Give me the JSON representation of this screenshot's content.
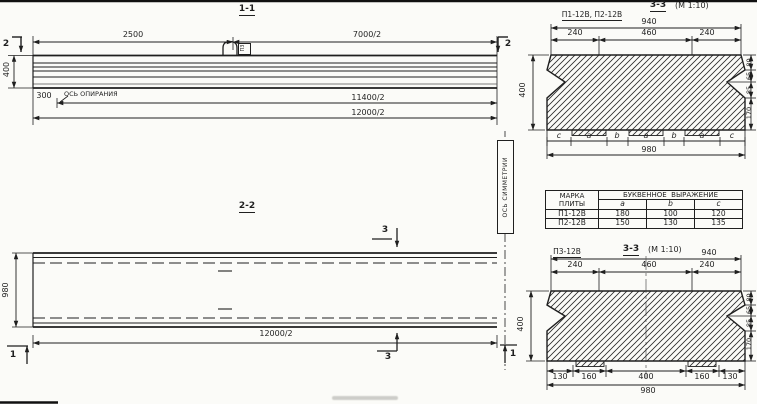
{
  "colors": {
    "ink": "#1f1f1f",
    "paper": "#fbfbf8"
  },
  "section_1_1": {
    "title": "1-1",
    "dim_left_top": "2500",
    "dim_right_top": "7000/2",
    "dim_bearing_offset": "300",
    "bearing_axis_label": "ОСЬ ОПИРАНИЯ",
    "dim_mid": "11400/2",
    "dim_bottom": "12000/2",
    "dim_height": "400",
    "cut_left": "2",
    "cut_right": "2",
    "hook_tag": "П3"
  },
  "symmetry_label": "ОСЬ СИММЕТРИИ",
  "section_2_2": {
    "title": "2-2",
    "dim_height": "980",
    "dim_bottom": "12000/2",
    "cut_top": "3",
    "cut_bottom": "3",
    "cut_left": "1",
    "cut_right": "1"
  },
  "section_top_right": {
    "plates": "П1-12В, П2-12В",
    "title": "3-3",
    "scale": "(М 1:10)",
    "dim_940": "940",
    "dims_240_460": [
      "240",
      "460",
      "240"
    ],
    "letters": [
      "c",
      "a",
      "b",
      "a",
      "b",
      "a",
      "c"
    ],
    "dim_980": "980",
    "dim_height": "400",
    "dims_right": [
      "80",
      "65",
      "85",
      "170"
    ]
  },
  "table": {
    "head_mark_1": "МАРКА",
    "head_mark_2": "ПЛИТЫ",
    "head_expr": "БУКВЕННОЕ  ВЫРАЖЕНИЕ",
    "cols": [
      "a",
      "b",
      "c"
    ],
    "rows": [
      {
        "mark": "П1-12В",
        "a": "180",
        "b": "100",
        "c": "120"
      },
      {
        "mark": "П2-12В",
        "a": "150",
        "b": "130",
        "c": "135"
      }
    ]
  },
  "section_bottom_right": {
    "plate": "П3-12В",
    "title": "3-3",
    "scale": "(М 1:10)",
    "dim_940": "940",
    "dims_240_460": [
      "240",
      "460",
      "240"
    ],
    "dims_bottom": [
      "130",
      "160",
      "400",
      "160",
      "130"
    ],
    "dim_980": "980",
    "dim_height": "400",
    "dims_right": [
      "80",
      "65",
      "85",
      "170"
    ]
  }
}
